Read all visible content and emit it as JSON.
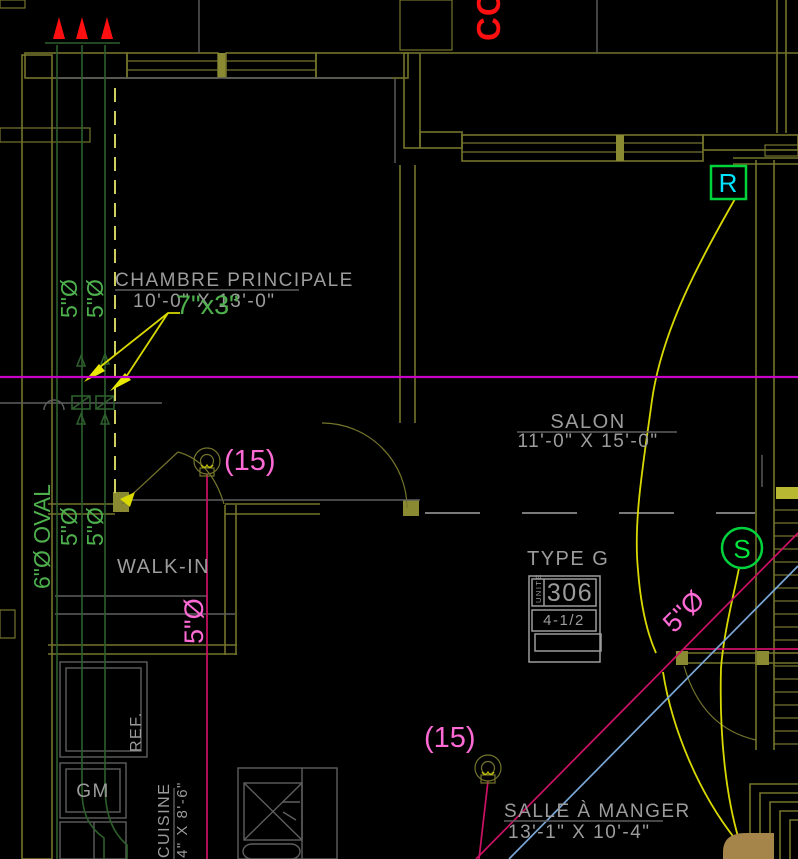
{
  "rooms": {
    "chambre": {
      "name": "CHAMBRE PRINCIPALE",
      "dims": "10'-0\" X 13'-0\""
    },
    "salon": {
      "name": "SALON",
      "dims": "11'-0\" X 15'-0\""
    },
    "walkin": {
      "name": "WALK-IN"
    },
    "salle_a_manger": {
      "name": "SALLE À MANGER",
      "dims": "13'-1\" X 10'-4\""
    },
    "cuisine": {
      "name": "CUISINE",
      "dims": "4\" X 8'-6\""
    }
  },
  "ducts": {
    "riser_a": "5\"Ø",
    "riser_b": "5\"Ø",
    "riser_c": "5\"Ø",
    "riser_d": "5\"Ø",
    "oval_label": "6\"Ø OVAL",
    "grille_size": "7\"x3\"",
    "walkin_duct": "5\"Ø",
    "salle_duct": "5\"Ø"
  },
  "annotations": {
    "co_riser": "CO",
    "count_a": "(15)",
    "count_b": "(15)",
    "return_tag": "R",
    "supply_tag": "S"
  },
  "unit_block": {
    "title": "TYPE G",
    "unit_label": "UNITÉ",
    "unit_number": "306",
    "unit_fraction": "4-1/2"
  },
  "kitchen": {
    "fridge": "REF.",
    "gm": "GM"
  },
  "colors": {
    "background": "#000000",
    "wall_olive": "#74742c",
    "wall_bright": "#9a9a3a",
    "text_gray": "#9c9c9c",
    "duct_green": "#4db04d",
    "riser_green": "#2d5f2d",
    "annotation_pink": "#ff6ad5",
    "sprinkler_crimson": "#cc1166",
    "reference_magenta": "#c800c8",
    "leader_yellow": "#d9d900",
    "plumbing_blue": "#7aa7d6",
    "alarm_red": "#ff0f0f",
    "tag_green": "#00d23c",
    "tag_cyan": "#00e5ff"
  }
}
